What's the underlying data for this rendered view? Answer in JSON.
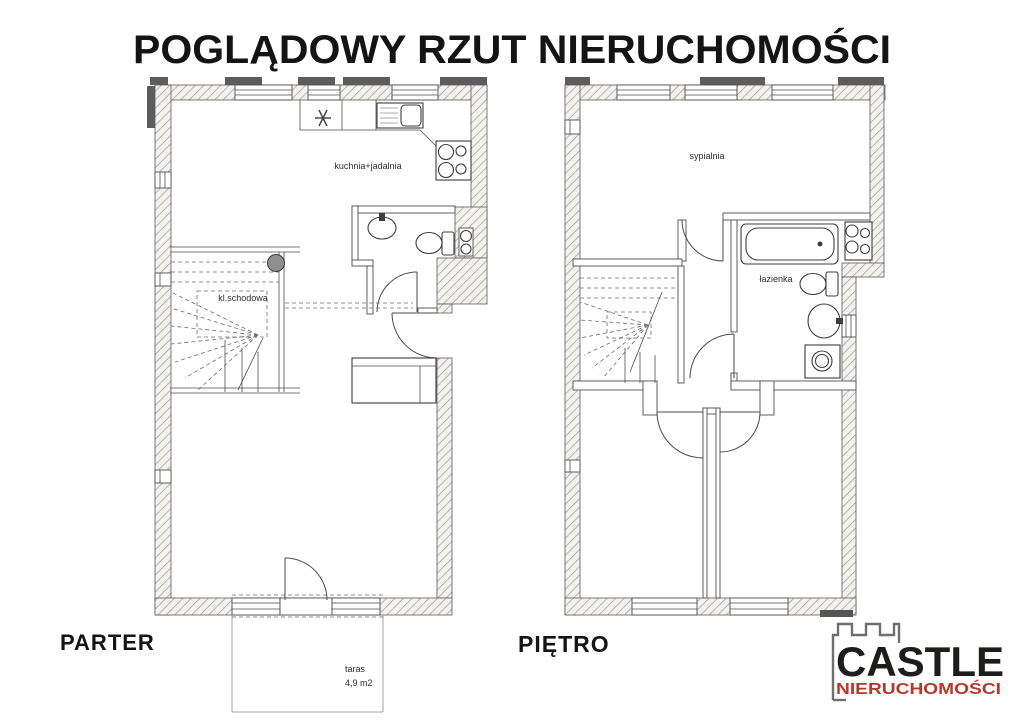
{
  "title": "POGLĄDOWY RZUT NIERUCHOMOŚCI",
  "parter": {
    "label": "PARTER",
    "rooms": {
      "kitchen_dining": "kuchnia+jadalnia",
      "staircase": "kl.schodowa",
      "terrace": "taras",
      "terrace_area": "4,9 m2"
    }
  },
  "pietro": {
    "label": "PIĘTRO",
    "rooms": {
      "bedroom": "sypialnia",
      "bathroom": "łazienka"
    }
  },
  "logo": {
    "brand": "CASTLE",
    "subtitle": "NIERUCHOMOŚCI",
    "brand_color": "#1d1d1b",
    "subtitle_color": "#b6382c",
    "castle_outline_color": "#6f6f6f"
  },
  "colors": {
    "background": "#ffffff",
    "plan_line": "#4e4e4e",
    "wall_hatch": "#9a9a9a",
    "dark_band": "#5c5c5c"
  }
}
